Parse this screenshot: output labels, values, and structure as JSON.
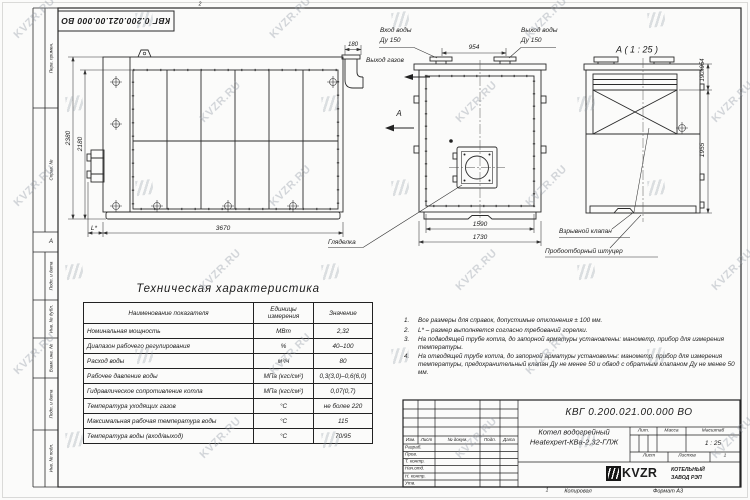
{
  "sheet": {
    "watermark_text": "KVZR.RU",
    "stamp_top": "КВГ 0.200.021.00.000 ВО",
    "zone_top": "2",
    "zone_left": "А",
    "zone_bottom": "1"
  },
  "strip": {
    "c1": "Перв. примен.",
    "c2": "Справ. №",
    "c3": "Подп. и дата",
    "c4": "Инв. № дубл.",
    "c5": "Взам. инв. №",
    "c6": "Подп. и дата",
    "c7": "Инв. № подл."
  },
  "views": {
    "side": {
      "dim_height_outer": "2380",
      "dim_height_inner": "2180",
      "dim_length": "3670",
      "dim_burner": "L*",
      "dim_outlet": "180",
      "label_gas_out": "Выход газов",
      "view_letter": "А"
    },
    "front": {
      "label_in_1": "Вход воды",
      "label_in_2": "Ду 150",
      "label_out_1": "Выход воды",
      "label_out_2": "Ду 150",
      "dim_nozzles": "954",
      "dim_inner": "1590",
      "dim_outer": "1730",
      "label_sight": "Гляделка"
    },
    "section": {
      "title": "А ( 1 : 25 )",
      "dim_top": "190х954",
      "dim_height": "1955",
      "label_valve": "Взрывной клапан",
      "label_sampler": "Пробоотборный штуцер"
    }
  },
  "spec_table": {
    "title": "Техническая характеристика",
    "col_name": "Наименование показателя",
    "col_units": "Единицы измерения",
    "col_value": "Значение",
    "rows": [
      {
        "name": "Номинальная мощность",
        "units": "МВт",
        "value": "2,32"
      },
      {
        "name": "Диапазон рабочего регулирования",
        "units": "%",
        "value": "40–100"
      },
      {
        "name": "Расход воды",
        "units": "м³/ч",
        "value": "80"
      },
      {
        "name": "Рабочее давление воды",
        "units": "МПа (кгс/см²)",
        "value": "0,3(3,0)–0,6(6,0)"
      },
      {
        "name": "Гидравлическое сопротивление котла",
        "units": "МПа (кгс/см²)",
        "value": "0,07(0,7)"
      },
      {
        "name": "Температура уходящих газов",
        "units": "°С",
        "value": "не более 220"
      },
      {
        "name": "Максимальная рабочая температура воды",
        "units": "°С",
        "value": "115"
      },
      {
        "name": "Температура воды (вход/выход)",
        "units": "°С",
        "value": "70/95"
      }
    ]
  },
  "notes": {
    "items": [
      {
        "num": "1.",
        "text": "Все размеры для справок, допустимые отклонения ± 100 мм."
      },
      {
        "num": "2.",
        "text": "L* – размер выполняется согласно требований горелки."
      },
      {
        "num": "3.",
        "text": "На подводящей трубе котла, до запорной арматуры установлены: манометр, прибор для измерения температуры."
      },
      {
        "num": "4.",
        "text": "На отводящей трубе котла, до запорной арматуры установелны: манометр, прибор для измерения температуры, предохранительный клапан Ду не менее 50 и обвод с обратным клапаном Ду не менее 50 мм."
      }
    ]
  },
  "title_block": {
    "doc_number": "КВГ 0.200.021.00.000 ВО",
    "product_line1": "Котел водогрейный",
    "product_line2": "Heatexpert-КВа-2,32-ГЛЖ",
    "h_izm": "Изм.",
    "h_list": "Лист",
    "h_doc": "№ докум.",
    "h_podp": "Подп.",
    "h_data": "Дата",
    "r1": "Разраб.",
    "r2": "Пров.",
    "r3": "Т. контр.",
    "r4": "Нач.отд.",
    "r5": "Н. контр.",
    "r6": "Утв.",
    "lit": "Лит.",
    "mass": "Масса",
    "scale_label": "Масштаб",
    "scale": "1 : 25",
    "sheet_label": "Лист",
    "sheets_label": "Листов",
    "sheets_value": "1",
    "brand": "KVZR",
    "company1": "КОТЕЛЬНЫЙ",
    "company2": "ЗАВОД РЭП",
    "copy": "Копировал",
    "format": "Формат А3"
  }
}
